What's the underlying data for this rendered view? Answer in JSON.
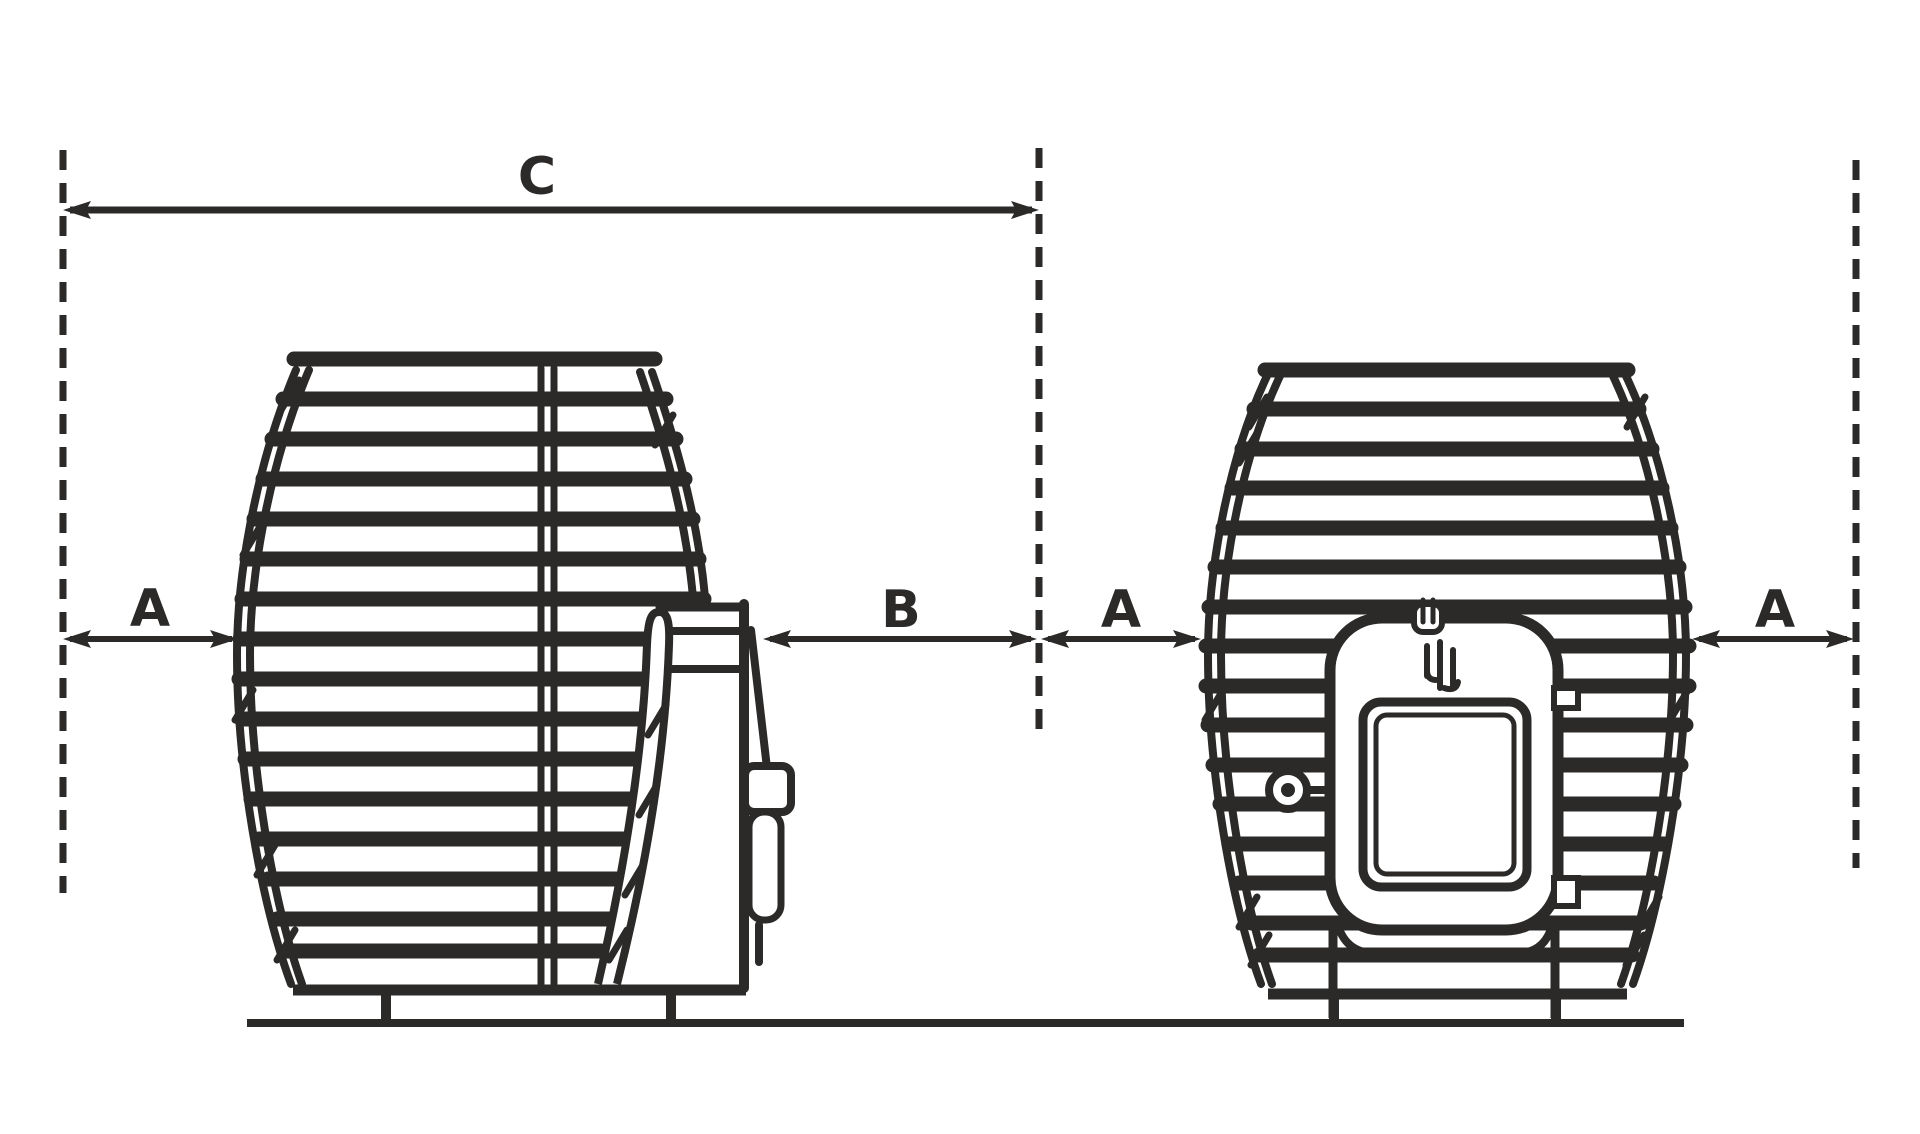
{
  "page": {
    "colors": {
      "background": "#ffffff",
      "ink": "#2b2a29"
    }
  },
  "figure": {
    "type": "technical-dimension-drawing",
    "description": "Side view of barrel hot tub with external heater (left) and front view of barrel hot tub with stove door (right), with spacing dimensions",
    "dimensions": {
      "c": {
        "label": "C"
      },
      "a_left": {
        "label": "A"
      },
      "b": {
        "label": "B"
      },
      "a_middle": {
        "label": "A"
      },
      "a_right": {
        "label": "A"
      }
    }
  }
}
